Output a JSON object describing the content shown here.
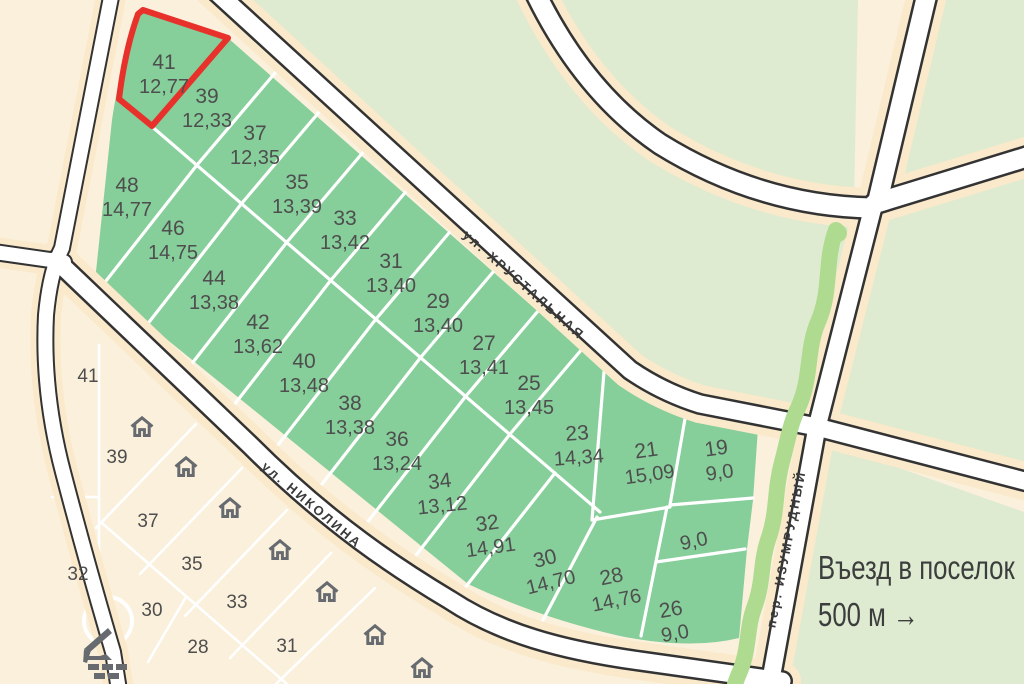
{
  "map": {
    "colors": {
      "bg": "#FAF0DC",
      "pale": "#DFEBD0",
      "green": "#86CE9A",
      "veg": "#AEDB90",
      "buffer": "#FAE9CA",
      "road": "#FFFFFF",
      "casing": "#333333",
      "accent": "#E8312A",
      "label": "#4E4E4E",
      "icon": "#676B6F"
    },
    "selected_plot": {
      "number": "41",
      "area": "12,77"
    },
    "green_plots": [
      {
        "number": "41",
        "area": "12,77",
        "x": 164,
        "y": 75,
        "rot": 0,
        "selected": true
      },
      {
        "number": "39",
        "area": "12,33",
        "x": 207,
        "y": 109,
        "rot": 0
      },
      {
        "number": "37",
        "area": "12,35",
        "x": 255,
        "y": 146,
        "rot": 0
      },
      {
        "number": "35",
        "area": "13,39",
        "x": 297,
        "y": 195,
        "rot": 0
      },
      {
        "number": "33",
        "area": "13,42",
        "x": 345,
        "y": 231,
        "rot": 0
      },
      {
        "number": "31",
        "area": "13,40",
        "x": 391,
        "y": 274,
        "rot": 0
      },
      {
        "number": "29",
        "area": "13,40",
        "x": 438,
        "y": 314,
        "rot": 0
      },
      {
        "number": "27",
        "area": "13,41",
        "x": 484,
        "y": 356,
        "rot": 0
      },
      {
        "number": "25",
        "area": "13,45",
        "x": 529,
        "y": 396,
        "rot": 0
      },
      {
        "number": "23",
        "area": "14,34",
        "x": 578,
        "y": 446,
        "rot": -4
      },
      {
        "number": "21",
        "area": "15,09",
        "x": 648,
        "y": 463,
        "rot": -8
      },
      {
        "number": "19",
        "area": "9,0",
        "x": 718,
        "y": 461,
        "rot": -8
      },
      {
        "number": "48",
        "area": "14,77",
        "x": 127,
        "y": 198,
        "rot": 0
      },
      {
        "number": "46",
        "area": "14,75",
        "x": 173,
        "y": 241,
        "rot": 0
      },
      {
        "number": "44",
        "area": "13,38",
        "x": 214,
        "y": 291,
        "rot": 0
      },
      {
        "number": "42",
        "area": "13,62",
        "x": 258,
        "y": 335,
        "rot": 0
      },
      {
        "number": "40",
        "area": "13,48",
        "x": 304,
        "y": 374,
        "rot": 0
      },
      {
        "number": "38",
        "area": "13,38",
        "x": 350,
        "y": 416,
        "rot": 0
      },
      {
        "number": "36",
        "area": "13,24",
        "x": 397,
        "y": 452,
        "rot": 0
      },
      {
        "number": "34",
        "area": "13,12",
        "x": 441,
        "y": 494,
        "rot": -6
      },
      {
        "number": "32",
        "area": "14,91",
        "x": 489,
        "y": 536,
        "rot": -8
      },
      {
        "number": "30",
        "area": "14,70",
        "x": 548,
        "y": 571,
        "rot": -14
      },
      {
        "number": "28",
        "area": "14,76",
        "x": 614,
        "y": 589,
        "rot": -12
      },
      {
        "number": "26",
        "area": "9,0",
        "x": 673,
        "y": 622,
        "rot": -10
      },
      {
        "number": "",
        "area": "9,0",
        "x": 694,
        "y": 542,
        "rot": -12
      }
    ],
    "sold_zone_plots": [
      {
        "number": "41",
        "x": 88,
        "y": 377
      },
      {
        "number": "39",
        "x": 117,
        "y": 458
      },
      {
        "number": "37",
        "x": 148,
        "y": 522
      },
      {
        "number": "35",
        "x": 192,
        "y": 565
      },
      {
        "number": "33",
        "x": 237,
        "y": 603
      },
      {
        "number": "31",
        "x": 287,
        "y": 647
      },
      {
        "number": "32",
        "x": 78,
        "y": 575
      },
      {
        "number": "30",
        "x": 152,
        "y": 611
      },
      {
        "number": "28",
        "x": 198,
        "y": 648
      }
    ],
    "houses": [
      {
        "x": 142,
        "y": 432
      },
      {
        "x": 186,
        "y": 472
      },
      {
        "x": 230,
        "y": 513
      },
      {
        "x": 280,
        "y": 555
      },
      {
        "x": 327,
        "y": 597
      },
      {
        "x": 375,
        "y": 640
      },
      {
        "x": 422,
        "y": 673
      }
    ],
    "streets": [
      {
        "label": "ул. ХРУСТАЛЬНАЯ",
        "x": 524,
        "y": 285,
        "rotation": 41.5
      },
      {
        "label": "ул. НИКОЛИНА",
        "x": 312,
        "y": 505,
        "rotation": 40
      },
      {
        "label": "пер. ИЗУМРУДНЫЙ",
        "x": 786,
        "y": 549,
        "rotation": -79
      }
    ],
    "entrance_sign": {
      "line1": "Въезд в поселок",
      "line2": "500 м →"
    }
  }
}
